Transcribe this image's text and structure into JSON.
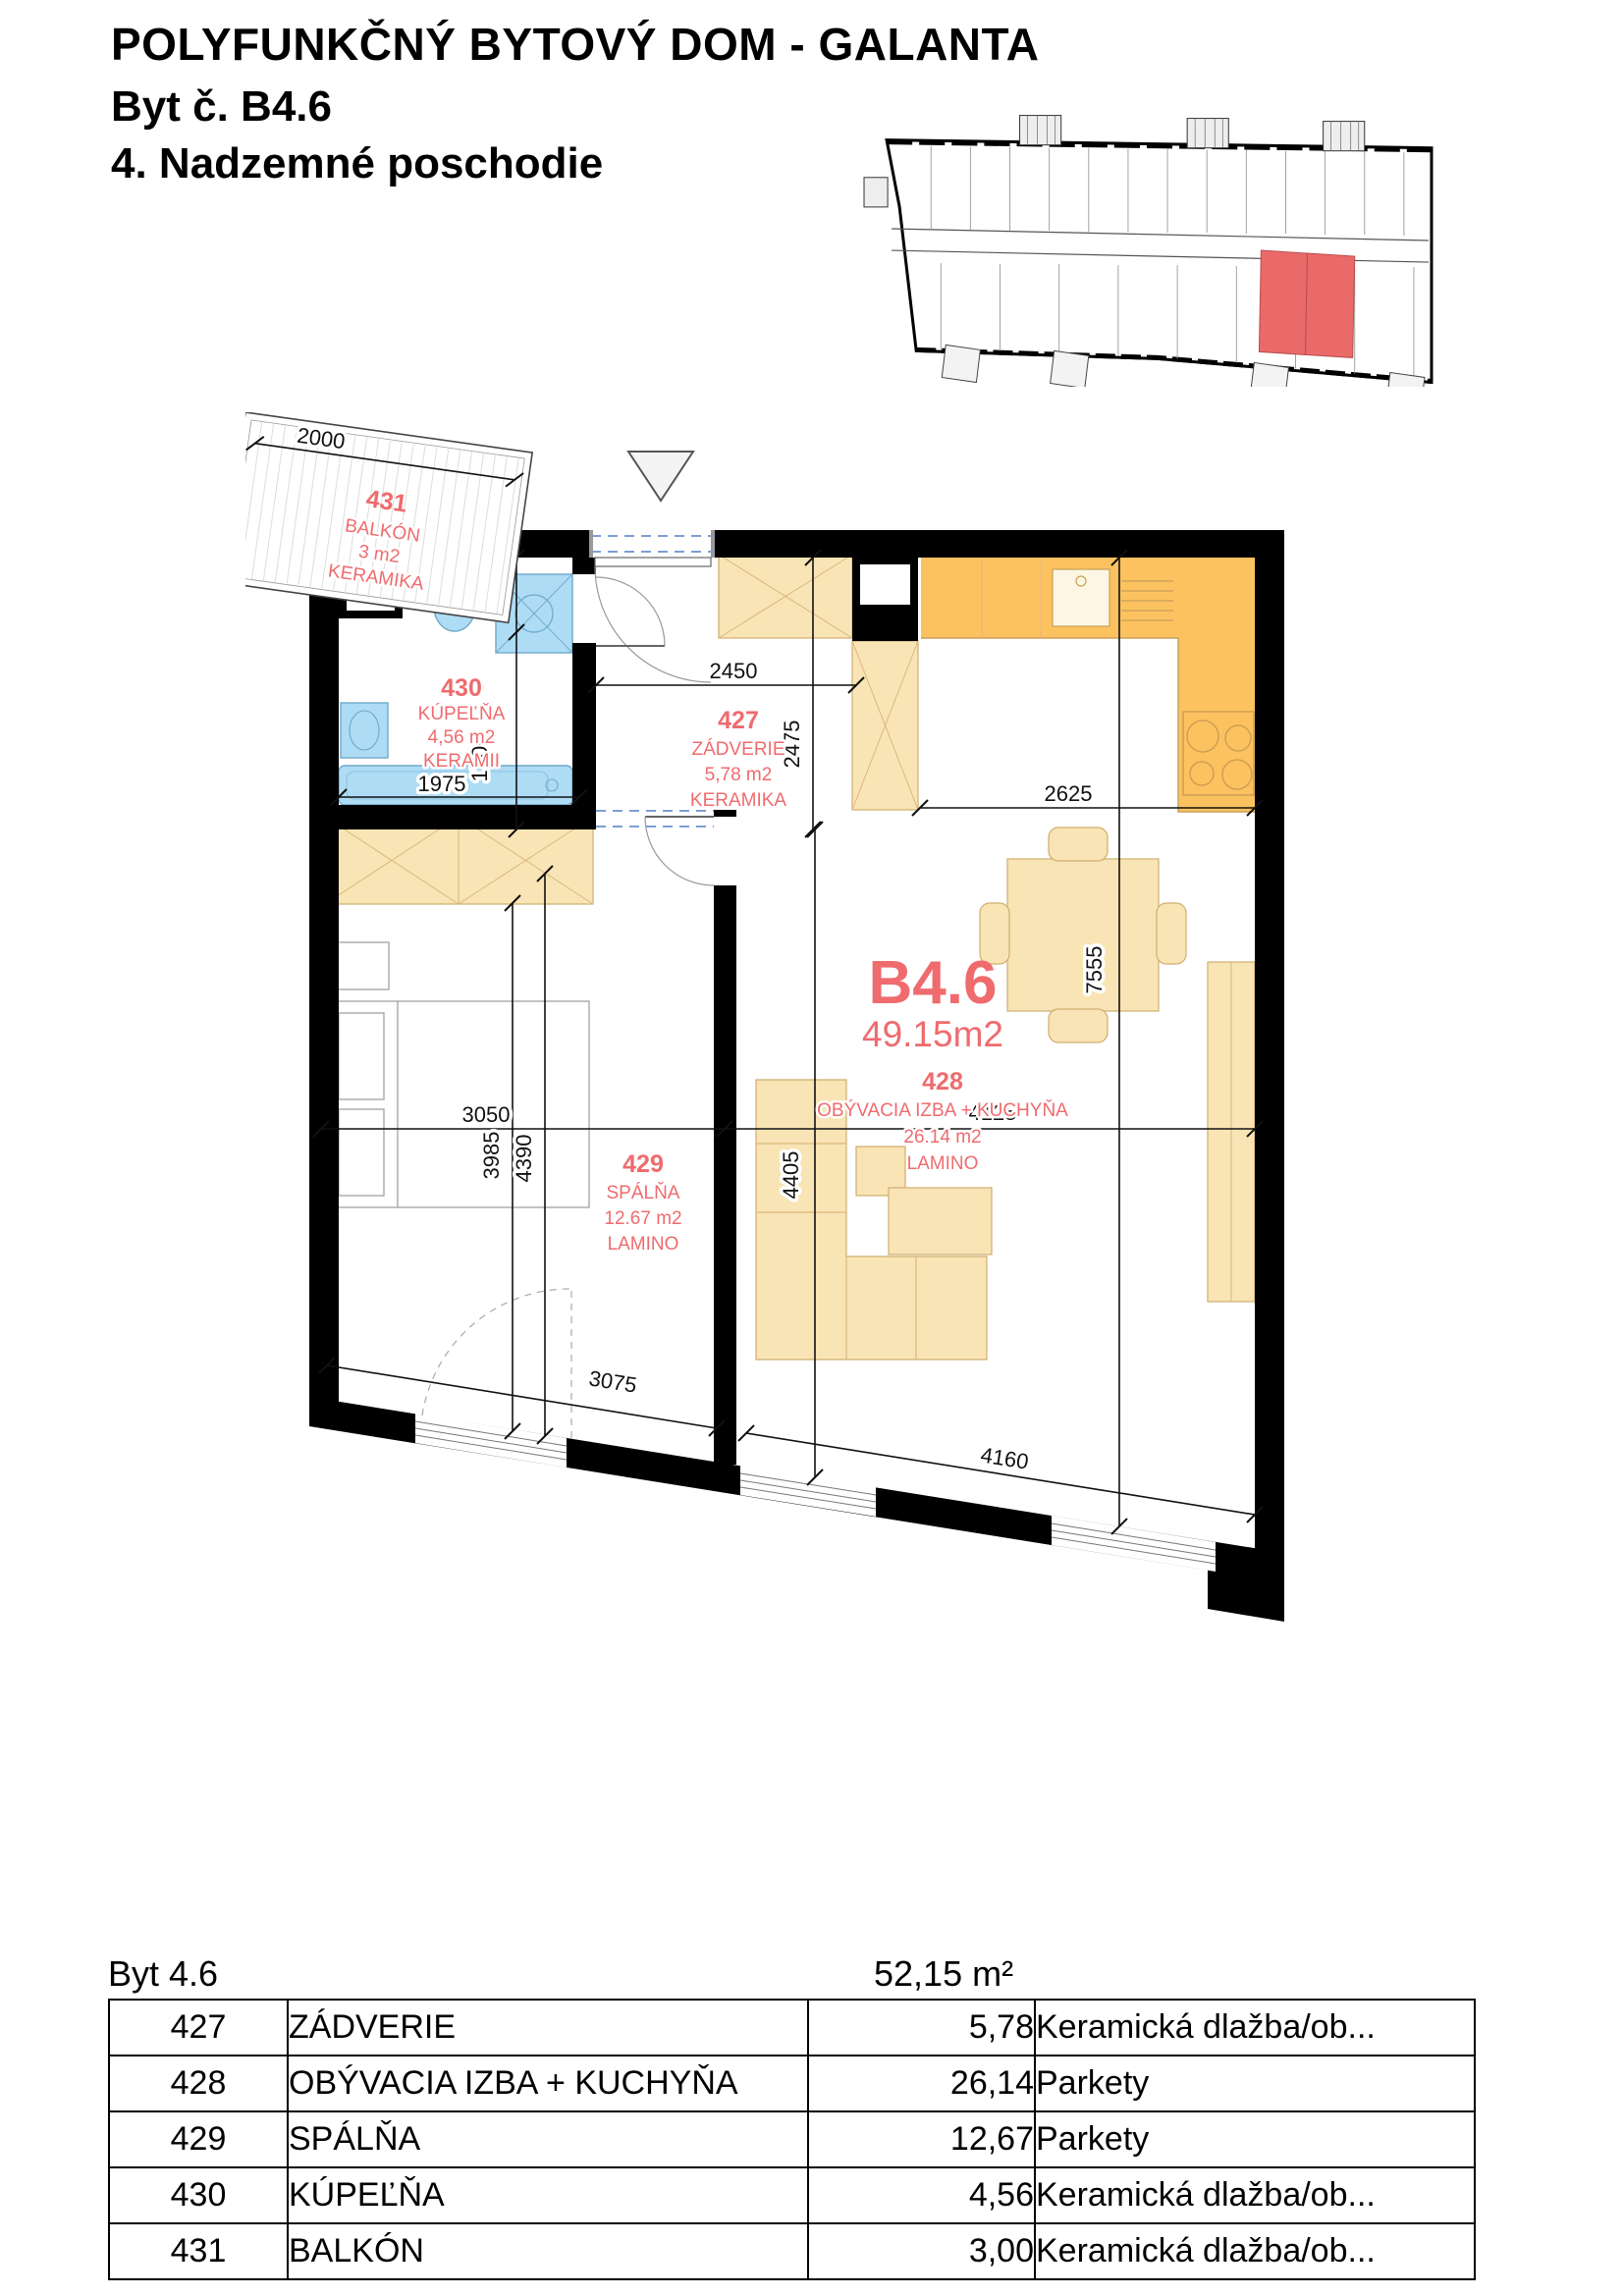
{
  "header": {
    "title": "POLYFUNKČNÝ BYTOVÝ DOM  -  GALANTA",
    "subtitle": "Byt č. B4.6",
    "floor": "4. Nadzemné poschodie"
  },
  "plan": {
    "unit_label": "B4.6",
    "unit_area": "49.15m2",
    "rooms": [
      {
        "number": "430",
        "name": "KÚPEĽŇA",
        "area": "4,56 m2",
        "material": "KERAMII"
      },
      {
        "number": "427",
        "name": "ZÁDVERIE",
        "area": "5,78 m2",
        "material": "KERAMIKA"
      },
      {
        "number": "428",
        "name": "OBÝVACIA IZBA + KUCHYŇA",
        "area": "26.14 m2",
        "material": "LAMINO"
      },
      {
        "number": "429",
        "name": "SPÁLŇA",
        "area": "12.67 m2",
        "material": "LAMINO"
      },
      {
        "number": "431",
        "name": "BALKÓN",
        "area": "3 m2",
        "material": "KERAMIKA"
      }
    ],
    "dimensions": {
      "d775": "775",
      "d1700": "1700",
      "d1975": "1975",
      "d2450": "2450",
      "d2475": "2475",
      "d2625": "2625",
      "d7555": "7555",
      "d3050": "3050",
      "d3985": "3985",
      "d4390": "4390",
      "d4405": "4405",
      "d4125": "4125",
      "d3075": "3075",
      "d4160": "4160",
      "d2000": "2000"
    }
  },
  "table": {
    "unit_label": "Byt 4.6",
    "total_area": "52,15 m²",
    "rows": [
      {
        "number": "427",
        "name": "ZÁDVERIE",
        "area": "5,78",
        "material": "Keramická dlažba/ob..."
      },
      {
        "number": "428",
        "name": "OBÝVACIA IZBA + KUCHYŇA",
        "area": "26,14",
        "material": "Parkety"
      },
      {
        "number": "429",
        "name": "SPÁLŇA",
        "area": "12,67",
        "material": "Parkety"
      },
      {
        "number": "430",
        "name": "KÚPEĽŇA",
        "area": "4,56",
        "material": "Keramická dlažba/ob..."
      },
      {
        "number": "431",
        "name": "BALKÓN",
        "area": "3,00",
        "material": "Keramická dlažba/ob..."
      }
    ]
  },
  "colors": {
    "accent_red": "#ef6b6e",
    "highlight_red": "#ea6a6a",
    "kitchen_orange": "#fbc25f",
    "furniture_tan": "#f9e4b5",
    "fixture_blue": "#aedcf5",
    "wall_black": "#000000"
  }
}
